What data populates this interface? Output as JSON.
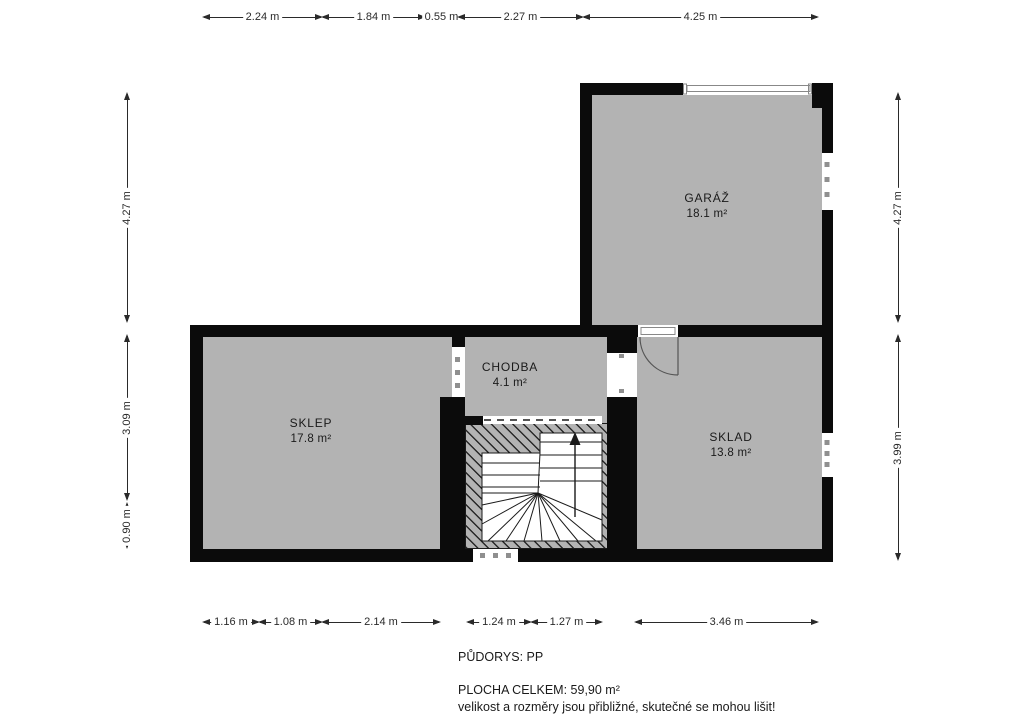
{
  "plan": {
    "title": "floor plan - basement",
    "rooms": [
      {
        "key": "garaz",
        "name": "GARÁŽ",
        "area": "18.1 m²"
      },
      {
        "key": "sklep",
        "name": "SKLEP",
        "area": "17.8 m²"
      },
      {
        "key": "chodba",
        "name": "CHODBA",
        "area": "4.1 m²"
      },
      {
        "key": "sklad",
        "name": "SKLAD",
        "area": "13.8 m²"
      }
    ]
  },
  "dimensions": {
    "axes": {
      "top_y": 17,
      "bottom_y": 622,
      "left_x": 127,
      "right_x": 898
    },
    "top": [
      {
        "label": "2.24 m",
        "from": 203,
        "to": 322
      },
      {
        "label": "1.84 m",
        "from": 322,
        "to": 425
      },
      {
        "label": "0.55 m",
        "from": 425,
        "to": 458
      },
      {
        "label": "2.27 m",
        "from": 458,
        "to": 583
      },
      {
        "label": "4.25 m",
        "from": 583,
        "to": 818
      }
    ],
    "bottom": [
      {
        "label": "1.16 m",
        "from": 203,
        "to": 259
      },
      {
        "label": "1.08 m",
        "from": 259,
        "to": 322
      },
      {
        "label": "2.14 m",
        "from": 322,
        "to": 440
      },
      {
        "label": "1.24 m",
        "from": 467,
        "to": 531
      },
      {
        "label": "1.27 m",
        "from": 531,
        "to": 602
      },
      {
        "label": "3.46 m",
        "from": 635,
        "to": 818
      }
    ],
    "left": [
      {
        "label": "4.27 m",
        "from": 93,
        "to": 322
      },
      {
        "label": "3.09 m",
        "from": 335,
        "to": 500
      },
      {
        "label": "0.90 m",
        "from": 503,
        "to": 548
      }
    ],
    "right": [
      {
        "label": "4.27 m",
        "from": 93,
        "to": 322
      },
      {
        "label": "3.99 m",
        "from": 335,
        "to": 560
      }
    ]
  },
  "footer": {
    "floor_label": "PŮDORYS: PP",
    "area_total": "PLOCHA CELKEM: 59,90 m²",
    "disclaimer": "velikost a rozměry jsou přibližné, skutečné se mohou lišit!"
  },
  "colors": {
    "wall": "#0b0b0b",
    "floor": "#b3b3b3",
    "dimension": "#2a2a2a",
    "background": "#ffffff"
  }
}
